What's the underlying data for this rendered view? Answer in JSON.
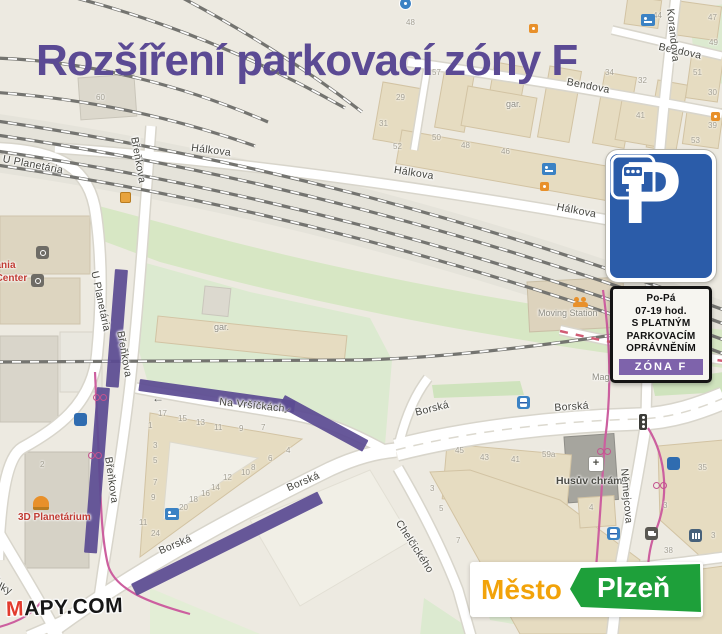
{
  "title": "Rozšíření parkovací zóny F",
  "colors": {
    "accent_purple": "#5b4a94",
    "zone_strip_purple": "#7e63ab",
    "sign_blue": "#2b5ca9",
    "bike_pink": "#c4538f",
    "city_orange": "#f2a30a",
    "city_green": "#1ea03a",
    "mapy_red": "#e23b2e"
  },
  "sign": {
    "p": "P",
    "lines": [
      "Po-Pá",
      "07-19 hod.",
      "S PLATNÝM",
      "PARKOVACÍM",
      "OPRÁVNĚNÍM"
    ],
    "zone": "ZÓNA F"
  },
  "logos": {
    "mapy": {
      "m": "M",
      "rest": "APY.COM"
    },
    "city": {
      "word1": "Město",
      "word2": "Plzeň"
    }
  },
  "streets": [
    {
      "label": "Hálkova",
      "x": 192,
      "y": 142,
      "rot": 7
    },
    {
      "label": "Hálkova",
      "x": 395,
      "y": 164,
      "rot": 9
    },
    {
      "label": "Hálkova",
      "x": 558,
      "y": 201,
      "rot": 11
    },
    {
      "label": "Bendova",
      "x": 568,
      "y": 76,
      "rot": 11
    },
    {
      "label": "Bendova",
      "x": 660,
      "y": 41,
      "rot": 12
    },
    {
      "label": "Korandova",
      "x": 676,
      "y": 8,
      "rot": 84
    },
    {
      "label": "U Planetária",
      "x": 4,
      "y": 153,
      "rot": 11
    },
    {
      "label": "U Planetária",
      "x": 100,
      "y": 270,
      "rot": 78
    },
    {
      "label": "U Planetária",
      "x": -2,
      "y": 420,
      "rot": 87
    },
    {
      "label": "Břeňkova",
      "x": 140,
      "y": 136,
      "rot": 80
    },
    {
      "label": "Břeňkova",
      "x": 126,
      "y": 330,
      "rot": 80
    },
    {
      "label": "Břeňkova",
      "x": 114,
      "y": 456,
      "rot": 82
    },
    {
      "label": "Na Vršíčkách",
      "x": 220,
      "y": 396,
      "rot": 6
    },
    {
      "label": "Borská",
      "x": 157,
      "y": 546,
      "rot": -23
    },
    {
      "label": "Borská",
      "x": 285,
      "y": 483,
      "rot": -23
    },
    {
      "label": "Borská",
      "x": 414,
      "y": 407,
      "rot": -14
    },
    {
      "label": "Borská",
      "x": 554,
      "y": 402,
      "rot": -4
    },
    {
      "label": "Chelčického",
      "x": 403,
      "y": 518,
      "rot": 57
    },
    {
      "label": "Němejcova",
      "x": 630,
      "y": 468,
      "rot": 85
    },
    {
      "label": "Emila Škody",
      "x": -26,
      "y": 530,
      "rot": 60
    },
    {
      "label": "alky",
      "x": -4,
      "y": 578,
      "rot": 25
    }
  ],
  "places": [
    {
      "t": "3D Planetárium",
      "x": 18,
      "y": 512,
      "cls": "red"
    },
    {
      "t": "Techmania",
      "x": -36,
      "y": 260,
      "cls": "red"
    },
    {
      "t": "Science Center",
      "x": -45,
      "y": 273,
      "cls": "red"
    },
    {
      "t": "Moving Station",
      "x": 538,
      "y": 308,
      "cls": "gray"
    },
    {
      "t": "Husův chrám",
      "x": 556,
      "y": 475,
      "cls": "dark"
    },
    {
      "t": "gar.",
      "x": 506,
      "y": 99,
      "cls": "gray"
    },
    {
      "t": "gar.",
      "x": 214,
      "y": 322,
      "cls": "gray"
    },
    {
      "t": "Mag",
      "x": 592,
      "y": 372,
      "cls": "gray"
    }
  ],
  "house_numbers": [
    {
      "n": "29",
      "x": 396,
      "y": 93
    },
    {
      "n": "31",
      "x": 379,
      "y": 119
    },
    {
      "n": "52",
      "x": 393,
      "y": 142
    },
    {
      "n": "50",
      "x": 432,
      "y": 133
    },
    {
      "n": "48",
      "x": 461,
      "y": 141
    },
    {
      "n": "46",
      "x": 501,
      "y": 147
    },
    {
      "n": "42",
      "x": 616,
      "y": 149
    },
    {
      "n": "57",
      "x": 432,
      "y": 68
    },
    {
      "n": "34",
      "x": 605,
      "y": 68
    },
    {
      "n": "32",
      "x": 638,
      "y": 76
    },
    {
      "n": "48",
      "x": 406,
      "y": 18
    },
    {
      "n": "44",
      "x": 653,
      "y": 11
    },
    {
      "n": "47",
      "x": 708,
      "y": 13
    },
    {
      "n": "49",
      "x": 709,
      "y": 38
    },
    {
      "n": "51",
      "x": 693,
      "y": 68
    },
    {
      "n": "30",
      "x": 708,
      "y": 88
    },
    {
      "n": "41",
      "x": 636,
      "y": 111
    },
    {
      "n": "39",
      "x": 708,
      "y": 121
    },
    {
      "n": "53",
      "x": 691,
      "y": 136
    },
    {
      "n": "60",
      "x": 96,
      "y": 93
    },
    {
      "n": "17",
      "x": 158,
      "y": 409
    },
    {
      "n": "15",
      "x": 178,
      "y": 414
    },
    {
      "n": "13",
      "x": 196,
      "y": 418
    },
    {
      "n": "11",
      "x": 214,
      "y": 423
    },
    {
      "n": "9",
      "x": 239,
      "y": 424
    },
    {
      "n": "7",
      "x": 261,
      "y": 423
    },
    {
      "n": "1",
      "x": 148,
      "y": 421
    },
    {
      "n": "3",
      "x": 153,
      "y": 441
    },
    {
      "n": "5",
      "x": 153,
      "y": 456
    },
    {
      "n": "7",
      "x": 153,
      "y": 478
    },
    {
      "n": "9",
      "x": 151,
      "y": 493
    },
    {
      "n": "11",
      "x": 139,
      "y": 518
    },
    {
      "n": "24",
      "x": 151,
      "y": 529
    },
    {
      "n": "20",
      "x": 179,
      "y": 503
    },
    {
      "n": "18",
      "x": 189,
      "y": 495
    },
    {
      "n": "16",
      "x": 201,
      "y": 489
    },
    {
      "n": "14",
      "x": 211,
      "y": 483
    },
    {
      "n": "12",
      "x": 223,
      "y": 473
    },
    {
      "n": "10",
      "x": 241,
      "y": 468
    },
    {
      "n": "8",
      "x": 251,
      "y": 463
    },
    {
      "n": "6",
      "x": 268,
      "y": 454
    },
    {
      "n": "4",
      "x": 286,
      "y": 446
    },
    {
      "n": "45",
      "x": 455,
      "y": 446
    },
    {
      "n": "43",
      "x": 480,
      "y": 453
    },
    {
      "n": "41",
      "x": 511,
      "y": 455
    },
    {
      "n": "59a",
      "x": 542,
      "y": 450
    },
    {
      "n": "3",
      "x": 430,
      "y": 484
    },
    {
      "n": "5",
      "x": 439,
      "y": 504
    },
    {
      "n": "7",
      "x": 456,
      "y": 536
    },
    {
      "n": "35",
      "x": 698,
      "y": 463
    },
    {
      "n": "3",
      "x": 663,
      "y": 501
    },
    {
      "n": "38",
      "x": 664,
      "y": 546
    },
    {
      "n": "3",
      "x": 711,
      "y": 531
    },
    {
      "n": "4",
      "x": 589,
      "y": 503
    },
    {
      "n": "2",
      "x": 40,
      "y": 460
    }
  ],
  "icons": [
    {
      "type": "parking",
      "x": 74,
      "y": 413
    },
    {
      "type": "parking",
      "x": 667,
      "y": 457
    },
    {
      "type": "hotel",
      "x": 542,
      "y": 163
    },
    {
      "type": "hotel",
      "x": 165,
      "y": 508
    },
    {
      "type": "hotel",
      "x": 641,
      "y": 14
    },
    {
      "type": "tram",
      "x": 517,
      "y": 396
    },
    {
      "type": "tram",
      "x": 607,
      "y": 527
    },
    {
      "type": "traffic",
      "x": 639,
      "y": 414
    },
    {
      "type": "cafe",
      "x": 645,
      "y": 527
    },
    {
      "type": "bank",
      "x": 689,
      "y": 529
    },
    {
      "type": "church",
      "x": 588,
      "y": 456,
      "glyph": "+"
    },
    {
      "type": "bike",
      "x": 93,
      "y": 392
    },
    {
      "type": "bike",
      "x": 88,
      "y": 450
    },
    {
      "type": "bike",
      "x": 653,
      "y": 480
    },
    {
      "type": "bike",
      "x": 597,
      "y": 446
    },
    {
      "type": "shop",
      "x": 540,
      "y": 182
    },
    {
      "type": "shop",
      "x": 529,
      "y": 24
    },
    {
      "type": "shop",
      "x": 711,
      "y": 112
    },
    {
      "type": "crossing",
      "x": 120,
      "y": 192
    },
    {
      "type": "theater",
      "x": 573,
      "y": 297
    },
    {
      "type": "dome",
      "x": 33,
      "y": 496
    },
    {
      "type": "museum",
      "x": 36,
      "y": 246
    },
    {
      "type": "museum",
      "x": 31,
      "y": 274
    },
    {
      "type": "pin",
      "x": 399,
      "y": -3
    },
    {
      "type": "arrow",
      "x": 152,
      "y": 393,
      "rot": 0,
      "glyph": "←"
    },
    {
      "type": "arrow",
      "x": 280,
      "y": 404,
      "rot": -35,
      "glyph": "←"
    }
  ],
  "zone_segments": [
    {
      "x": 115,
      "y": 269,
      "w": 13,
      "h": 118,
      "rot": 4.5
    },
    {
      "x": 97,
      "y": 387,
      "w": 13,
      "h": 166,
      "rot": 4.5
    },
    {
      "x": 140,
      "y": 379,
      "w": 157,
      "h": 12,
      "rot": 8
    },
    {
      "x": 285,
      "y": 395,
      "w": 95,
      "h": 13,
      "rot": 28.5
    },
    {
      "x": 131,
      "y": 584,
      "w": 208,
      "h": 13,
      "rot": -26.4
    }
  ]
}
